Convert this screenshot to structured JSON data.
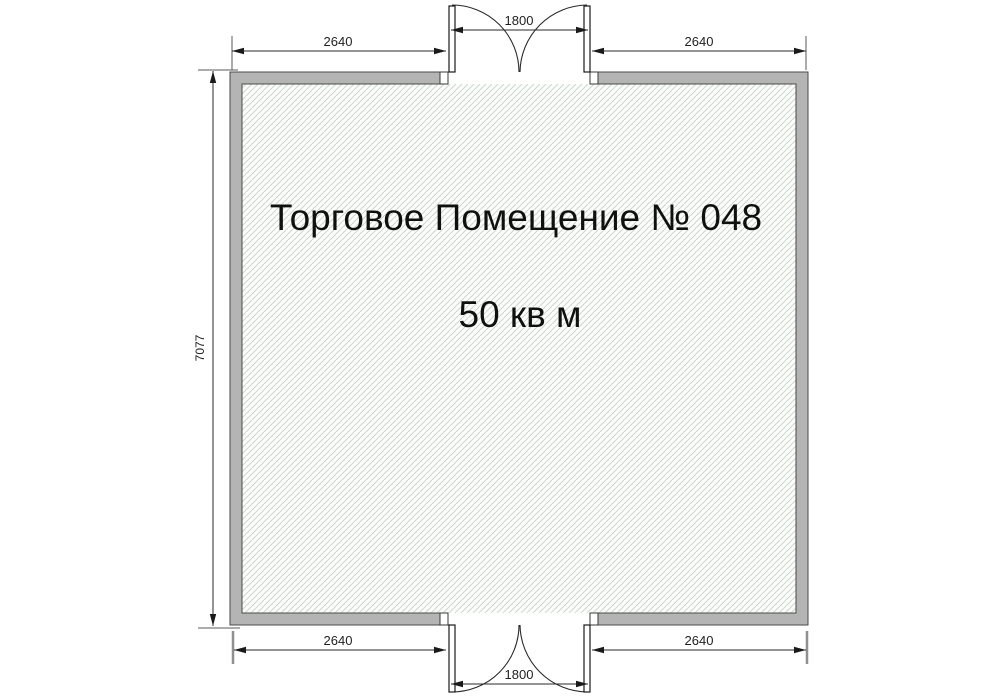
{
  "plan": {
    "title": "Торговое Помещение № 048",
    "area": "50 кв м",
    "dims": {
      "top_left": "2640",
      "top_door": "1800",
      "top_right": "2640",
      "left_side": "7077",
      "bottom_left": "2640",
      "bottom_door": "1800",
      "bottom_right": "2640"
    },
    "colors": {
      "wall_fill": "#b4b4b4",
      "wall_outline": "#4a4a4a",
      "floor_background": "#fdfdfb",
      "hatch_line": "#ccd6cd",
      "dimension_line": "#2a2a2a",
      "text": "#101010"
    }
  }
}
